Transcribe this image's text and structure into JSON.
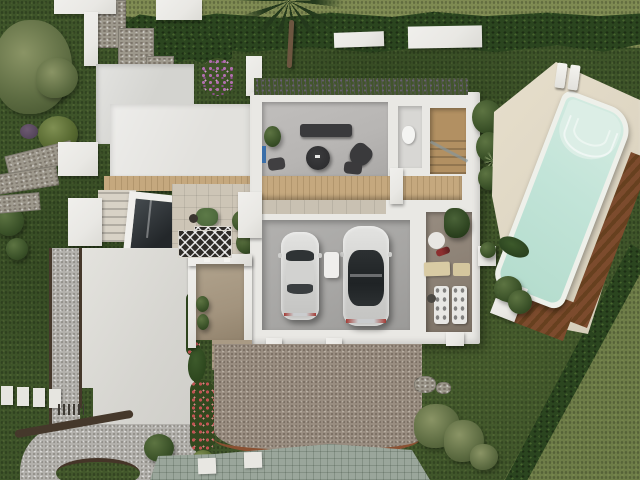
{
  "meta": {
    "description": "Aerial top-down 3D architectural rendering of a modern white villa with the roof removed over the main wing, showing interior rooms, a two-car garage, landscaped gardens, gravel paths, a paver driveway and an angled swimming pool with sun loungers.",
    "view": "top-down aerial render",
    "visible_text": "none"
  },
  "palette": {
    "grassDark": "#3e5429",
    "grassLight": "#7e8a52",
    "hedge": "#2b451f",
    "whiteWall": "#e9e8e4",
    "roofMid": "#d4d4d0",
    "roofLight": "#e2e1dd",
    "floorLiving": "#b7b5b3",
    "floorGarage": "#a7a6a4",
    "floorGym": "#8a7f73",
    "floorCourt": "#a3947e",
    "wood": "#c5a87e",
    "woodDark": "#7c4b2d",
    "tilePatio": "#cdc5b6",
    "poolWater": "#c2e4d8",
    "poolSteps": "#dceee6",
    "poolCoping": "#eef0ea",
    "deckCream": "#ded6c3",
    "gravelLight": "#b3b1ac",
    "gravelBrown": "#998d80",
    "paver": "#9aa69b",
    "edgingDark": "#45382b",
    "edgingRust": "#8a5132",
    "stone": "#9d988c",
    "flowerRed": "#c25454",
    "flowerPurple": "#b06fae",
    "carBody": "#d9d9d7",
    "glassDark": "#2f3335",
    "furnitureDark": "#3a3a3c",
    "chairGreen": "#4f6b3d",
    "accentBlue": "#3a6ea8",
    "palmTrunk": "#6d5640"
  },
  "scene": {
    "areas": {
      "garden": "dark green lawn garden",
      "neighborLawnTop": "lighter neighboring lawn beyond top hedge",
      "neighborLawnCorner": "lighter neighboring lawn beyond diagonal hedge",
      "hedgeTop": "trimmed boundary hedge along top",
      "hedgeDiagonal": "low diagonal boundary hedge",
      "palmTree": "palm tree",
      "oliveTree": "olive tree",
      "flatRoof": "white flat roof slab",
      "courtyardPatio": "tiled light-well courtyard with green lounge chair and patterned rug",
      "skylight": "glass skylight over lower level",
      "stairsNorthwest": "exterior steps beside skylight",
      "concreteTerrace": "white concrete terrace pad",
      "gravelPath": "light gravel path with dark edging",
      "steppingStones": "white stepping stones in lawn",
      "livingRoom": "living room with dark sofa, round table and armchair",
      "bathroom": "bathroom with toilet",
      "staircase": "interior wooden staircase with glass rail",
      "woodenDeck": "slatted wooden deck strip",
      "garage": "garage with two white cars",
      "carLeft": "white car (left bay)",
      "carRight": "white car with dark glass roof (right bay)",
      "gymRoom": "fitness room with mats and equipment",
      "entryCourtyard": "recessed entry courtyard with steps",
      "tiledWalkway": "decorative patterned tile walkway",
      "flowerBed": "flower bed with red blooms and cypresses",
      "gravelYard": "brown gravel yard",
      "paverDriveway": "curved grey paver driveway",
      "rocks": "decorative boulders",
      "bushes": "round garden bushes",
      "poolDeck": "cream pool deck",
      "swimmingPool": "swimming pool with roman steps",
      "woodenPoolEdge": "wooden deck edge of pool",
      "sunLoungers": "two white sun loungers",
      "planters": "white planters with greenery"
    }
  }
}
